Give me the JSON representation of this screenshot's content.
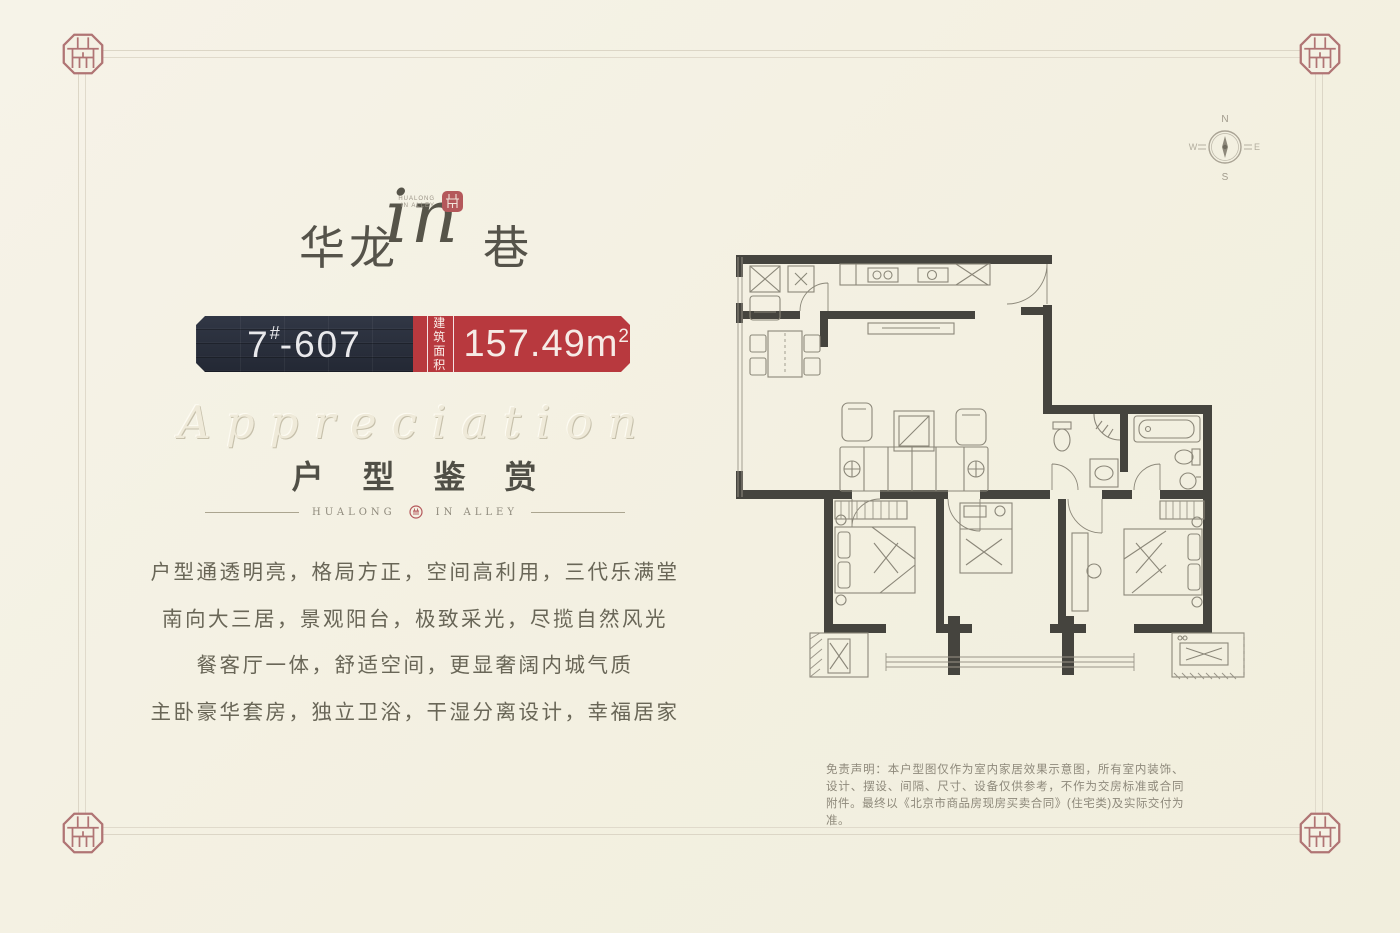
{
  "page": {
    "background": "#f4f1e4",
    "accent_red": "#b8393e",
    "badge_dark": "#2b303b",
    "seal_red": "#b07272"
  },
  "logo": {
    "hualong": "华龙",
    "in_script": "in",
    "xiang": "巷",
    "micro_line1": "HUALONG",
    "micro_line2": "IN ALLEY"
  },
  "badge": {
    "unit_number": "7",
    "unit_sup": "#",
    "unit_rest": "-607",
    "area_label_line1": "建筑",
    "area_label_line2": "面积",
    "area_value": "157.49",
    "area_unit": "m",
    "area_unit_sup": "2"
  },
  "section": {
    "script_word": "Appreciation",
    "heading": "户 型 鉴 赏",
    "divider_left": "HUALONG",
    "divider_right": "IN ALLEY"
  },
  "description": {
    "lines": [
      "户型通透明亮，格局方正，空间高利用，三代乐满堂",
      "南向大三居，景观阳台，极致采光，尽揽自然风光",
      "餐客厅一体，舒适空间，更显奢阔内城气质",
      "主卧豪华套房，独立卫浴，干湿分离设计，幸福居家"
    ]
  },
  "compass": {
    "n": "N",
    "e": "E",
    "s": "S",
    "w": "W"
  },
  "disclaimer": "免责声明：本户型图仅作为室内家居效果示意图，所有室内装饰、设计、摆设、间隔、尺寸、设备仅供参考，不作为交房标准或合同附件。最终以《北京市商品房现房买卖合同》(住宅类)及实际交付为准。"
}
